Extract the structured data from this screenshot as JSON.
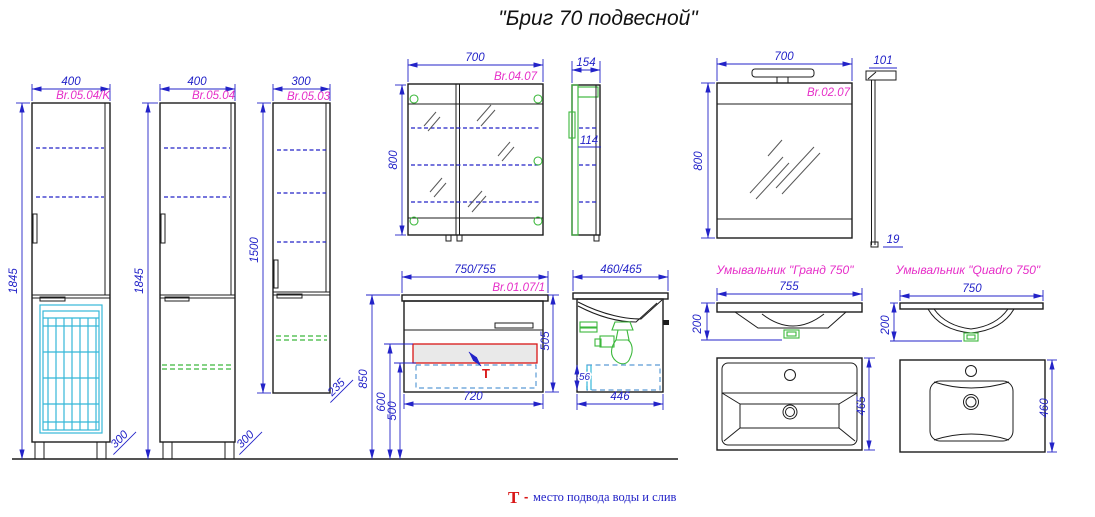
{
  "title": "\"Бриг 70 подвесной\"",
  "colors": {
    "line_dark": "#1c1c1c",
    "dim_blue": "#2323c8",
    "code_magenta": "#e62ec8",
    "detail_green": "#3cb83c",
    "basket_cyan": "#35b8d8",
    "drawer_blue": "#5b9bd5",
    "accent_red": "#d91717"
  },
  "pencil_case_k": {
    "code": "Br.05.04/K",
    "width": "400",
    "height": "1845",
    "depth": "300"
  },
  "pencil_case": {
    "code": "Br.05.04",
    "width": "400",
    "height": "1845",
    "depth": "300"
  },
  "half_case": {
    "code": "Br.05.03",
    "width": "300",
    "height": "1500",
    "depth": "235"
  },
  "mirror_cabinet": {
    "code": "Br.04.07",
    "width": "700",
    "height": "800",
    "depth": "154",
    "inner": "114"
  },
  "vanity": {
    "code": "Br.01.07/1",
    "width": "750/755",
    "height": "505",
    "bottom_width": "720",
    "h850": "850",
    "h600": "600",
    "h500": "500",
    "side_width": "460/465",
    "side_bottom": "446",
    "side_gap": "56"
  },
  "mirror": {
    "code": "Br.02.07",
    "width": "700",
    "height": "800",
    "top_depth": "101",
    "thickness": "19"
  },
  "basin_grand": {
    "title": "Умывальник \"Гранд 750\"",
    "width": "755",
    "height": "200",
    "depth": "465"
  },
  "basin_quadro": {
    "title": "Умывальник \"Quadro 750\"",
    "width": "750",
    "height": "200",
    "depth": "460"
  },
  "legend": {
    "symbol": "Т",
    "dash": "-",
    "text": "место подвода воды и слив"
  }
}
